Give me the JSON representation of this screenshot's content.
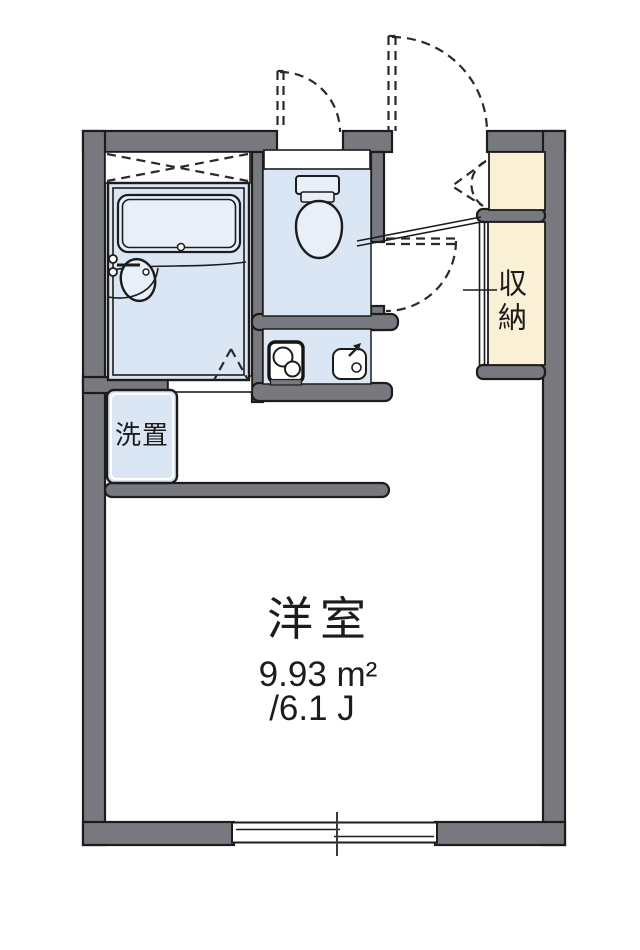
{
  "title": "apartment floor plan",
  "colors": {
    "wall": "#78787f",
    "line": "#1c1c1c",
    "room_blue": "#dbe6f4",
    "fixture_blue": "#e8eff9",
    "closet_beige": "#faf0d6",
    "white": "#ffffff"
  },
  "labels": {
    "main_room_name": "洋室",
    "main_room_area_m2": "9.93 m²",
    "main_room_area_jo": "/6.1 J",
    "storage_name": "収納",
    "washer_name": "洗置"
  },
  "fixtures": [
    "bathtub",
    "bath-sink",
    "bath-folding-door",
    "toilet",
    "stove-burner",
    "kitchen-sink",
    "washing-machine-space",
    "shoe-cabinet",
    "storage-closet",
    "entrance-door-swing",
    "toilet-window-swing",
    "room-door-swing",
    "sliding-window",
    "entrance-step"
  ]
}
